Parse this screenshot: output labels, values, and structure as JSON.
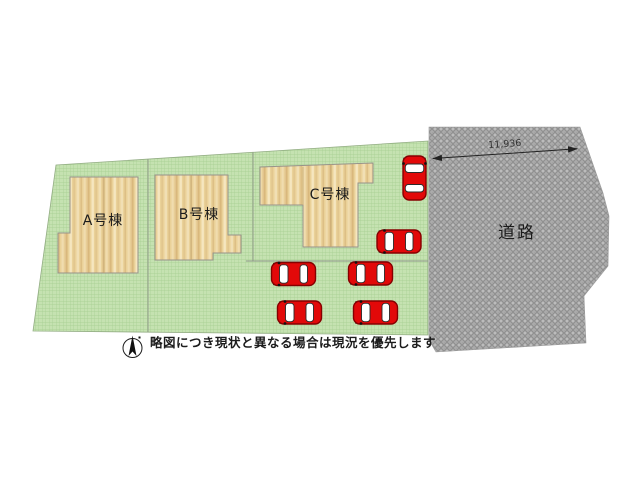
{
  "colors": {
    "grass": "#c5e2b1",
    "grass_grid": "#a5cd90",
    "wood": "#ead198",
    "wood_streak_dark": "#d9b87c",
    "wood_streak_light": "#f5e6bf",
    "road": "#ababab",
    "road_weave": "#8e8e8e",
    "road_light": "#c9c9c9",
    "car_red": "#e20909",
    "car_outline": "#850000",
    "ink": "#1c1c1c"
  },
  "site_plan": {
    "buildings": [
      {
        "id": "A",
        "label": "A号棟"
      },
      {
        "id": "B",
        "label": "B号棟"
      },
      {
        "id": "C",
        "label": "C号棟"
      }
    ],
    "road_label": "道路",
    "dimension_label": "11,936",
    "car_count": 6,
    "compass": "north-arrow",
    "disclaimer": "略図につき現状と異なる場合は現況を優先します"
  }
}
